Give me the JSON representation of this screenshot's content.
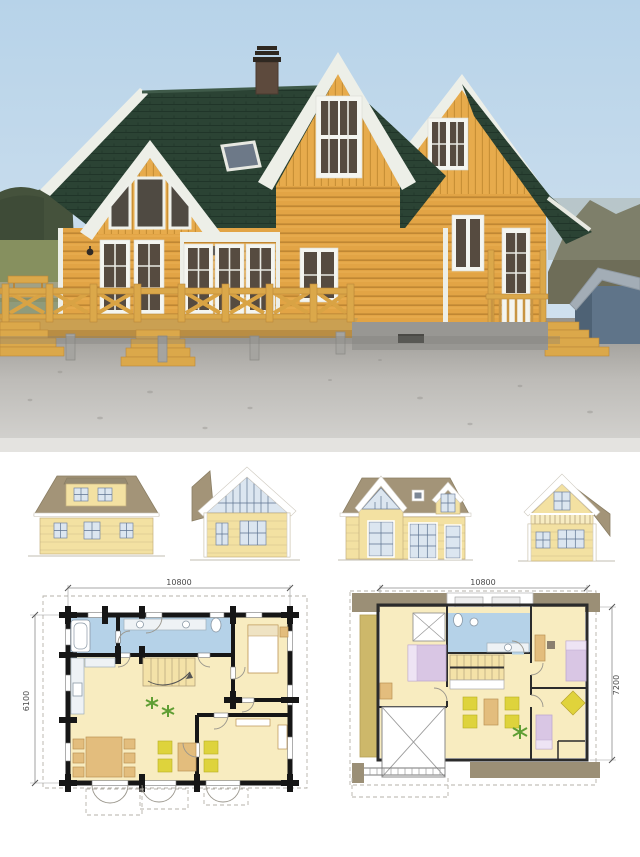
{
  "sheet": {
    "background": "#ffffff"
  },
  "photo": {
    "subject": "log-house-photo",
    "colors": {
      "sky": "#bcd5ea",
      "roof_shingles": "#2b4334",
      "log_walls": "#e2a445",
      "white_trim": "#edefe8",
      "deck_wood": "#d9a344",
      "gravel": "#c6c4c0",
      "forest": "#45523c",
      "hills": "#6e6d58",
      "shed_wall": "#5f7489",
      "shed_roof": "#a3adb6"
    }
  },
  "elevations": {
    "colors": {
      "roof": "#a39478",
      "wall": "#f3e1a2",
      "glass": "#dce6f0",
      "trim": "#ffffff"
    },
    "items": [
      {
        "id": "rear-elevation"
      },
      {
        "id": "left-gable-elevation"
      },
      {
        "id": "front-elevation"
      },
      {
        "id": "right-gable-elevation"
      }
    ]
  },
  "floor_plans": {
    "colors": {
      "floor": "#f8ecc0",
      "wet_area": "#b5d2e8",
      "walls": "#161616",
      "furniture_wood": "#e3bd7d",
      "chairs": "#ded33c",
      "beds": "#d9c6e4",
      "roof_area": "#9b8f76",
      "stairs": "#f4e2a8",
      "plant": "#5f9e33"
    },
    "ground_floor": {
      "width": "10800",
      "depth": "6100"
    },
    "upper_floor": {
      "width": "10800",
      "depth": "7200"
    }
  }
}
